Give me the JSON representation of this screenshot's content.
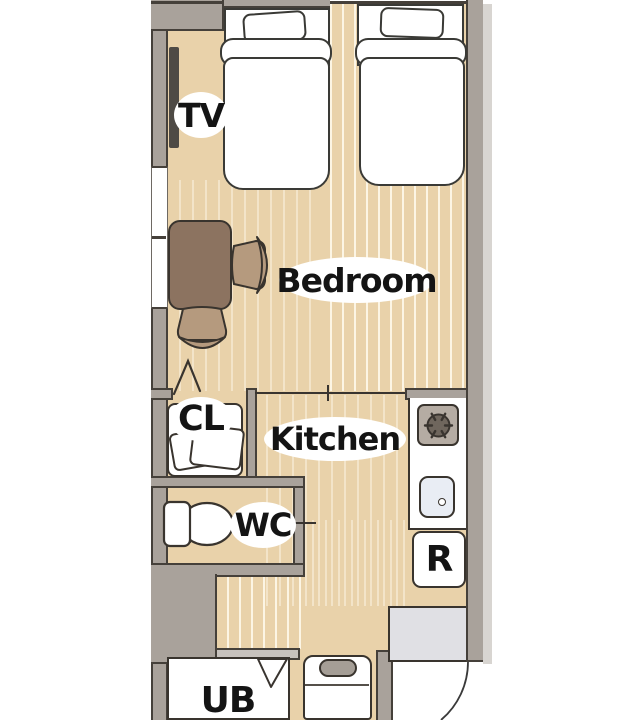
{
  "title": "studio-apartment-floor-plan",
  "labels": {
    "tv": "TV",
    "bedroom": "Bedroom",
    "kitchen": "Kitchen",
    "closet": "CL",
    "wc": "WC",
    "fridge": "R",
    "unit_bath": "UB"
  },
  "colors": {
    "background": "#FFFFFF",
    "floor": "#E9D2AA",
    "floor_grain": "#FFFBEE",
    "wall": "#A9A29B",
    "wall_light": "#C7C2BD",
    "outline": "#45403A",
    "table": "#8C7360",
    "chair": "#B59A7E",
    "tv_panel": "#4E4A45",
    "stove": "#B5ACA3",
    "burner": "#6F665D",
    "sink": "#E9EDF4",
    "genkan_tile": "#E0E0E4",
    "washer_panel": "#A59E96",
    "label_text": "#141414",
    "label_bg": "#FFFFFF"
  }
}
